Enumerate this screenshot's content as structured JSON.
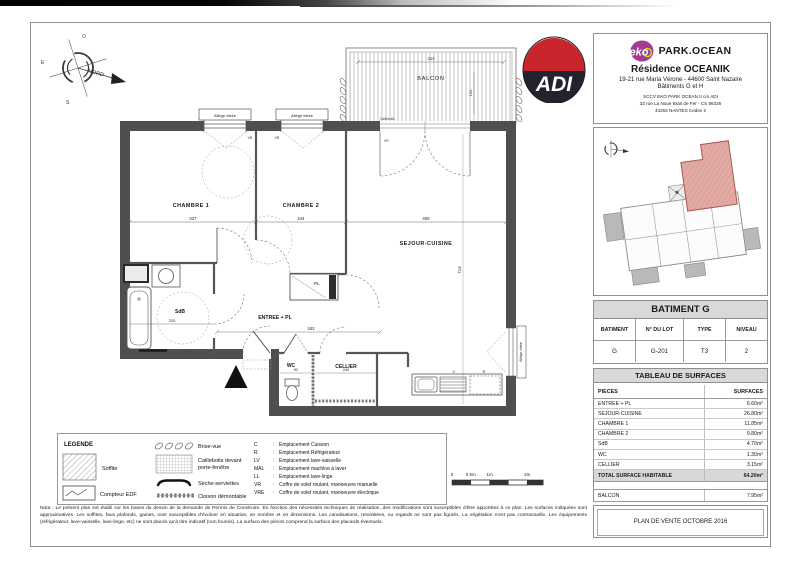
{
  "title_block": {
    "logo_text": "eko",
    "brand": "PARK.OCEAN",
    "residence": "Résidence OCEANIK",
    "address": "19-21 rue Maria Vérone - 44600 Saint Nazaire",
    "buildings": "Bâtiments G et H",
    "company1": "SCCV EKO PARK OCEAN II c/o ADI",
    "company2": "32 rue La Noue Bras de Fer - CS 86326",
    "company3": "44263 NANTES Cedex 2"
  },
  "adi": {
    "label": "ADI"
  },
  "compass": {
    "north": "NORD",
    "top": "O",
    "left": "E",
    "bottom": "S"
  },
  "building_table": {
    "title": "BATIMENT G",
    "headers": [
      "BATIMENT",
      "N° DU LOT",
      "TYPE",
      "NIVEAU"
    ],
    "values": [
      "G",
      "G-201",
      "T3",
      "2"
    ]
  },
  "surfaces": {
    "title": "TABLEAU DE SURFACES",
    "col_pieces": "PIECES",
    "col_surfaces": "SURFACES",
    "rows": [
      {
        "label": "ENTREE + PL",
        "value": "6.60m²"
      },
      {
        "label": "SEJOUR-CUISINE",
        "value": "26.80m²"
      },
      {
        "label": "CHAMBRE 1",
        "value": "11.85m²"
      },
      {
        "label": "CHAMBRE 2",
        "value": "9.80m²"
      },
      {
        "label": "SdB",
        "value": "4.70m²"
      },
      {
        "label": "WC",
        "value": "1.30m²"
      },
      {
        "label": "CELLIER",
        "value": "3.15m²"
      }
    ],
    "total_label": "TOTAL SURFACE HABITABLE",
    "total_value": "64.20m²",
    "balcon_label": "BALCON",
    "balcon_value": "7.95m²"
  },
  "stamp": {
    "label": "PLAN DE VENTE OCTOBRE 2016"
  },
  "legend": {
    "title": "LEGENDE",
    "sep": ":",
    "soffite": "Soffite",
    "compteur": "Compteur EDF",
    "brise_vue": "Brise-vue",
    "caillebotis1": "Caillebotis devant",
    "caillebotis2": "porte-fenêtre",
    "seche": "Sèche-serviettes",
    "cloison": "Cloison démontable",
    "abbrev": [
      {
        "code": "C",
        "desc": "Emplacement Cuisson"
      },
      {
        "code": "R",
        "desc": "Emplacement Réfrigérateur"
      },
      {
        "code": "LV",
        "desc": "Emplacement lave-vaisselle"
      },
      {
        "code": "MAL",
        "desc": "Emplacement machine à laver"
      },
      {
        "code": "LL",
        "desc": "Emplacement lave-linge"
      },
      {
        "code": "VR",
        "desc": "Coffre de volet roulant, manoeuvre manuelle"
      },
      {
        "code": "VRE",
        "desc": "Coffre de volet roulant, manoeuvre électrique"
      }
    ]
  },
  "scalebar": {
    "t0": "0",
    "t05": "0.5m",
    "t1": "1m",
    "t2": "2m"
  },
  "note": "Nota : Le présent plan est établi sur les bases du dessin de la demande de Permis de Construire. En fonction des nécessités techniques de réalisation, des modifications sont susceptibles d'être apportées à ce plan. Les surfaces indiquées sont approximatives. Les soffites, faux plafonds, gaines, sont susceptibles d'évoluer en situation, en nombre et en dimensions. Les canalisations, retombées, ou regards ne sont pas figurés. La végétation n'est pas contractuelle. Les équipements (réfrigérateur, lave-vaisselle, lave-linge, etc) ne sont placés qu'à titre indicatif (non fournis). La surface des pièces comprend la surface des placards éventuels.",
  "plan": {
    "rooms": {
      "balcon": "BALCON",
      "chambre1": "CHAMBRE 1",
      "chambre2": "CHAMBRE 2",
      "sejour": "SEJOUR-CUISINE",
      "sdb": "SdB",
      "entree": "ENTREE + PL",
      "pl": "PL",
      "wc": "WC",
      "cellier": "CELLIER"
    },
    "dims": {
      "chambre1": "327",
      "chambre2": "244",
      "sejour_w": "400",
      "sejour_h": "714",
      "entree": "342",
      "sdb": "220",
      "wc": "92",
      "cellier": "240",
      "balcon_w": "414",
      "balcon_h": "190"
    },
    "labels": {
      "allege": "Allège vitrée",
      "vr": "VR",
      "caillebotis": "Caillebotis",
      "c": "C",
      "r": "R"
    }
  }
}
